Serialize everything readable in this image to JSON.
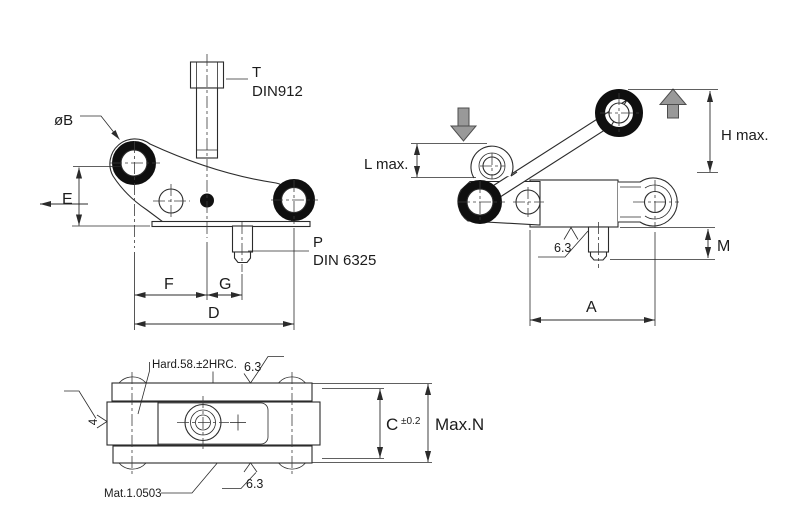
{
  "front_view": {
    "screw_ref": "T",
    "screw_standard": "DIN912",
    "roller_dia": "øB",
    "dim_e": "E",
    "dim_f": "F",
    "dim_g": "G",
    "dim_d": "D",
    "pin_ref": "P",
    "pin_standard": "DIN 6325"
  },
  "side_view": {
    "dim_l": "L max.",
    "dim_h": "H max.",
    "dim_m": "M",
    "dim_a": "A",
    "roughness": "6.3"
  },
  "top_view": {
    "hardness": "Hard.58.±2HRC.",
    "roughness_top": "6.3",
    "roughness_bottom": "6.3",
    "roughness_side": "4",
    "dim_c": "C",
    "dim_c_tol": "±0.2",
    "dim_n": "Max.N",
    "material": "Mat.1.0503"
  },
  "colors": {
    "line": "#2b2b2b",
    "ring_black": "#0f0f0f",
    "arrow_gray": "#999999",
    "background": "#ffffff"
  }
}
